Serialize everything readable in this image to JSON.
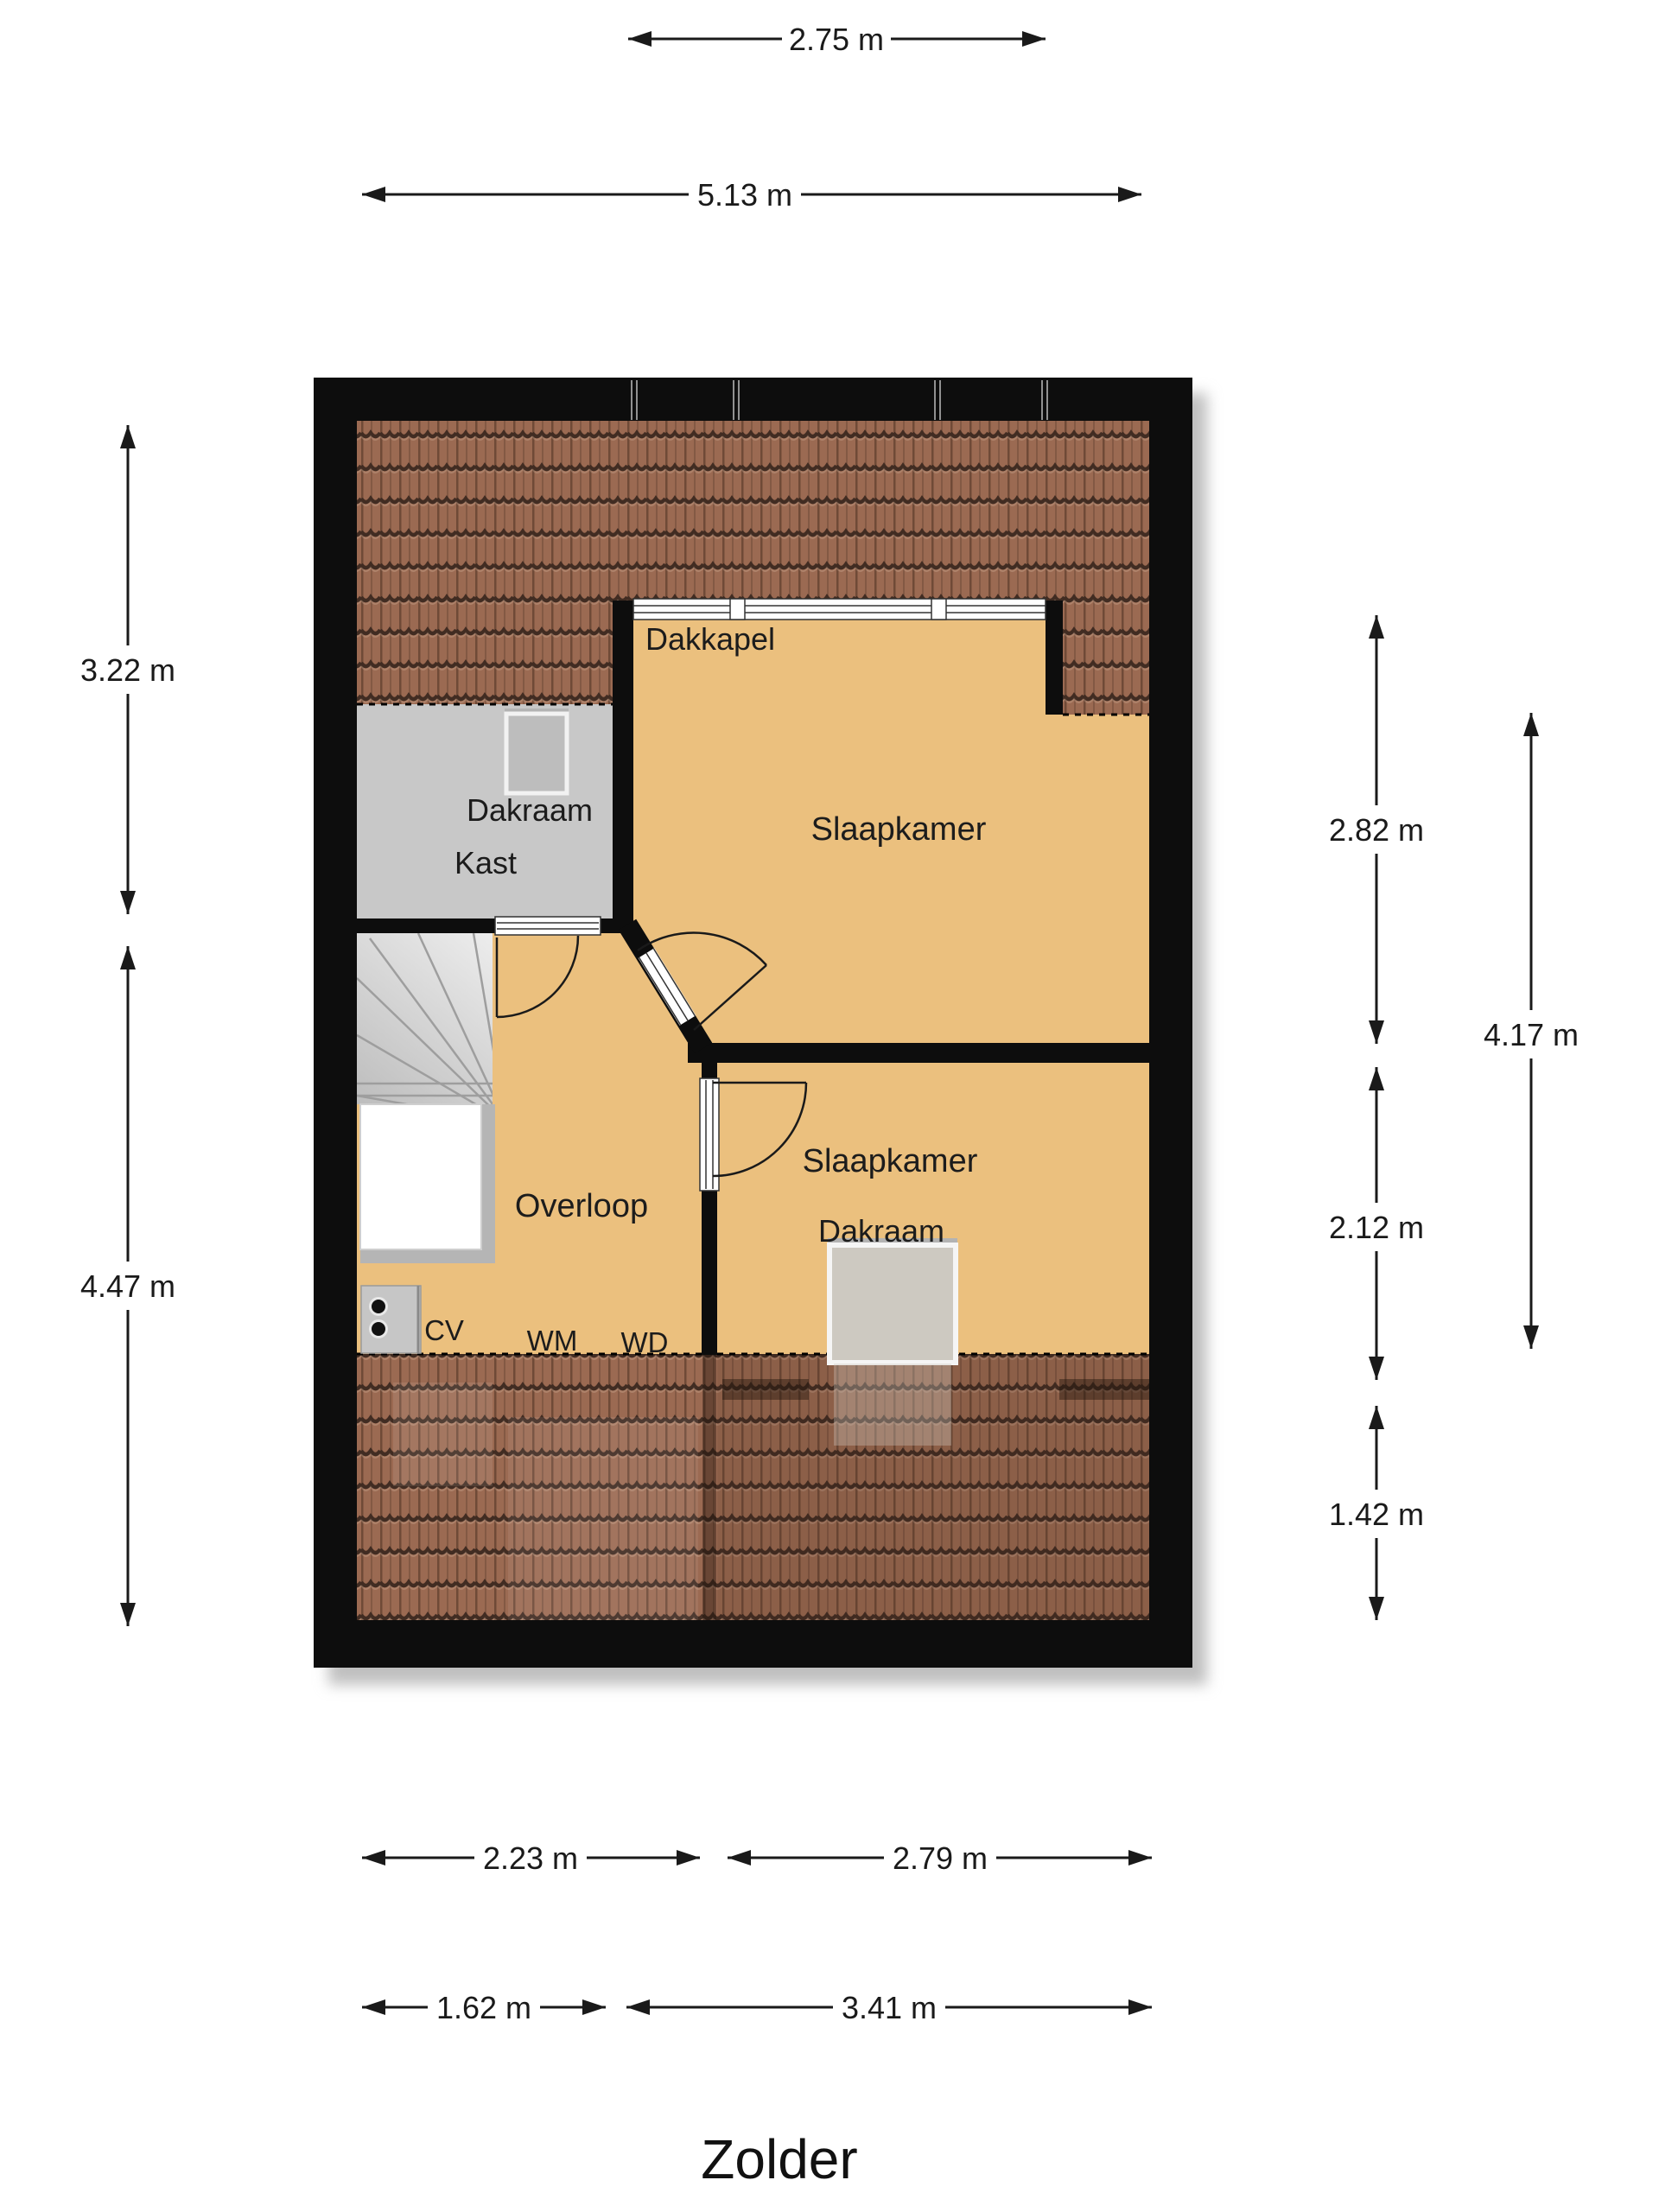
{
  "title": "Zolder",
  "rooms": {
    "slaapkamer_top": "Slaapkamer",
    "slaapkamer_bottom": "Slaapkamer",
    "kast": "Kast",
    "overloop": "Overloop",
    "dakkapel": "Dakkapel",
    "dakraam_top": "Dakraam",
    "dakraam_bottom": "Dakraam"
  },
  "appliances": {
    "cv": "CV",
    "wm": "WM",
    "wd": "WD"
  },
  "dims": {
    "d275": "2.75 m",
    "d513": "5.13 m",
    "d322": "3.22 m",
    "d447": "4.47 m",
    "d282": "2.82 m",
    "d212": "2.12 m",
    "d142": "1.42 m",
    "d417": "4.17 m",
    "d223": "2.23 m",
    "d279": "2.79 m",
    "d162": "1.62 m",
    "d341": "3.41 m"
  },
  "colors": {
    "floor": "#ebc07e",
    "roof_tile": "#9b6a52",
    "roof_line": "#412c22",
    "wall": "#0d0d0d",
    "closet": "#c8c8c8",
    "stair_light": "#ececec",
    "stair_dark": "#bfbfbf",
    "dimension_line": "#1a1a1a"
  }
}
